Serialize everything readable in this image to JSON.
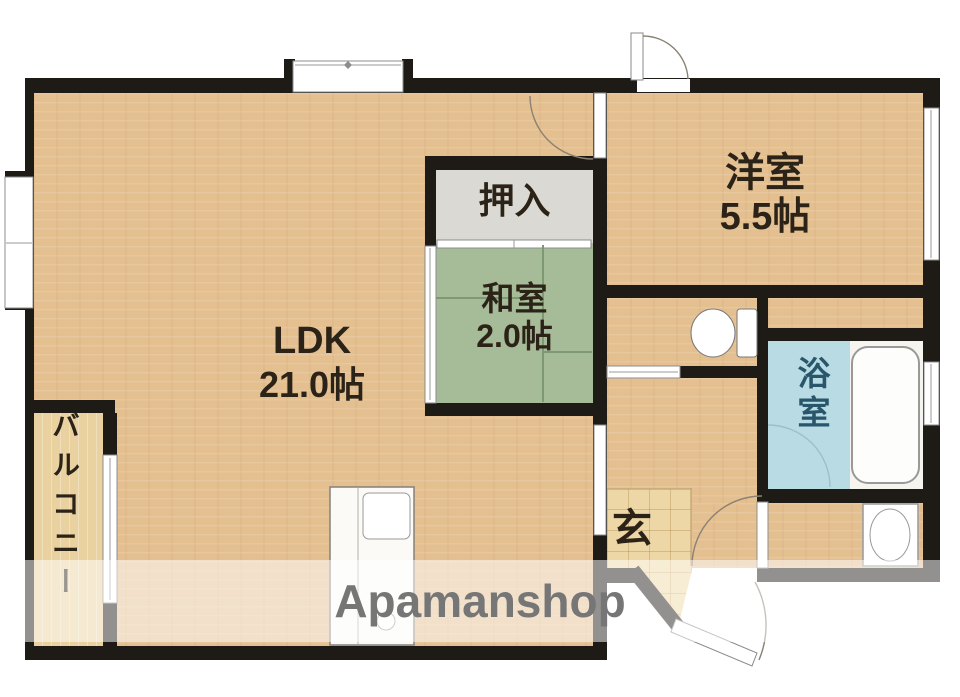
{
  "rooms": {
    "ldk": {
      "name": "LDK",
      "size": "21.0帖"
    },
    "yoshitsu": {
      "name": "洋室",
      "size": "5.5帖"
    },
    "washitsu": {
      "name": "和室",
      "size": "2.0帖"
    },
    "oshiire": {
      "name": "押入"
    },
    "bathroom": {
      "name": "浴室"
    },
    "genkan": {
      "name": "玄"
    },
    "balcony": {
      "name": "バルコニー"
    }
  },
  "watermark": {
    "text": "Apamanshop"
  },
  "fixtures": [
    "kitchen-sink-unit",
    "toilet",
    "bathtub",
    "washing-machine-pan"
  ],
  "colors": {
    "wall": "#1e1b16",
    "wood_floor": "#e4bf90",
    "tatami_green": "#a6bb97",
    "closet_gray": "#dbd9d3",
    "bath_blue": "#b8dbe4",
    "genkan_tile": "#eed7a6",
    "room_text": "#2b2317",
    "bath_text": "#2a566b",
    "watermark_gray": "#767676"
  }
}
